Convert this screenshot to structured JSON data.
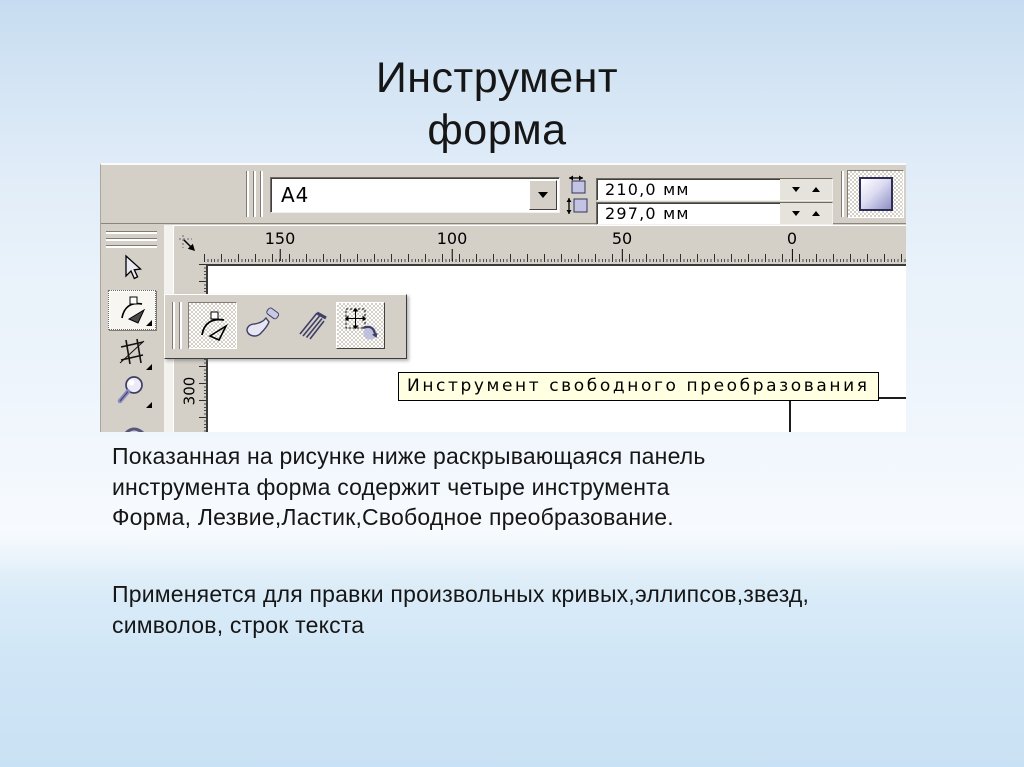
{
  "slide": {
    "title_line1": "Инструмент",
    "title_line2": "форма",
    "paragraph1_line1": "Показанная на рисунке ниже раскрывающаяся панель",
    "paragraph1_line2": "инструмента форма содержит четыре инструмента",
    "paragraph1_line3": "Форма, Лезвие,Ластик,Свободное преобразование.",
    "paragraph2_line1": "Применяется для правки произвольных кривых,эллипсов,звезд,",
    "paragraph2_line2": "символов, строк текста"
  },
  "screenshot": {
    "property_bar": {
      "paper_size_value": "А4",
      "paper_width_value": "210,0 мм",
      "paper_height_value": "297,0 мм"
    },
    "ruler": {
      "h_labels": [
        "150",
        "100",
        "50",
        "0"
      ],
      "v_label": "300"
    },
    "tooltip_text": "Инструмент свободного преобразования",
    "icons": {
      "toolbox": [
        "pick-tool-icon",
        "shape-tool-icon",
        "crop-tool-icon",
        "zoom-tool-icon"
      ],
      "flyout": [
        "shape-tool-icon",
        "smudge-brush-icon",
        "roughen-brush-icon",
        "free-transform-icon"
      ],
      "property_bar": [
        "paper-width-icon",
        "paper-height-icon",
        "portrait-orientation-icon",
        "dropdown-arrow-icon",
        "spinner-down-icon",
        "spinner-up-icon"
      ],
      "ruler": [
        "ruler-origin-icon"
      ]
    }
  },
  "colors": {
    "window_face": "#d4d0c8",
    "window_shadow": "#807c74",
    "tooltip_bg": "#ffffe1",
    "icon_accent": "#8f8fc6",
    "slide_bg_top": "#c6dcf0",
    "slide_bg_bottom": "#c9e1f4",
    "text": "#161616"
  }
}
